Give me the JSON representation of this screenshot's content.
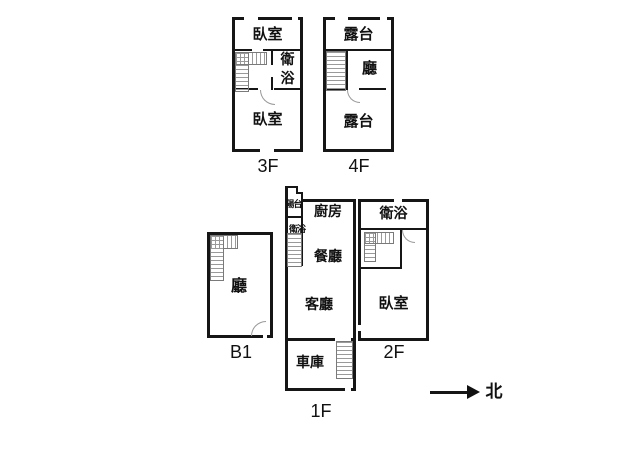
{
  "floor_3f": {
    "label": "3F",
    "bedroom_top": "臥室",
    "bathroom": "衛浴",
    "bedroom_bottom": "臥室"
  },
  "floor_4f": {
    "label": "4F",
    "terrace_top": "露台",
    "hall": "廳",
    "terrace_bottom": "露台"
  },
  "floor_b1": {
    "label": "B1",
    "hall": "廳"
  },
  "floor_1f": {
    "label": "1F",
    "balcony": "陽台",
    "bathroom": "衛浴",
    "kitchen": "廚房",
    "dining": "餐廳",
    "living": "客廳",
    "garage": "車庫"
  },
  "floor_2f": {
    "label": "2F",
    "bathroom": "衛浴",
    "bedroom": "臥室"
  },
  "compass": {
    "north": "北"
  },
  "colors": {
    "wall": "#161616",
    "background": "#ffffff",
    "stair_hatch": "#9a9a9a",
    "door_arc": "#999999"
  }
}
